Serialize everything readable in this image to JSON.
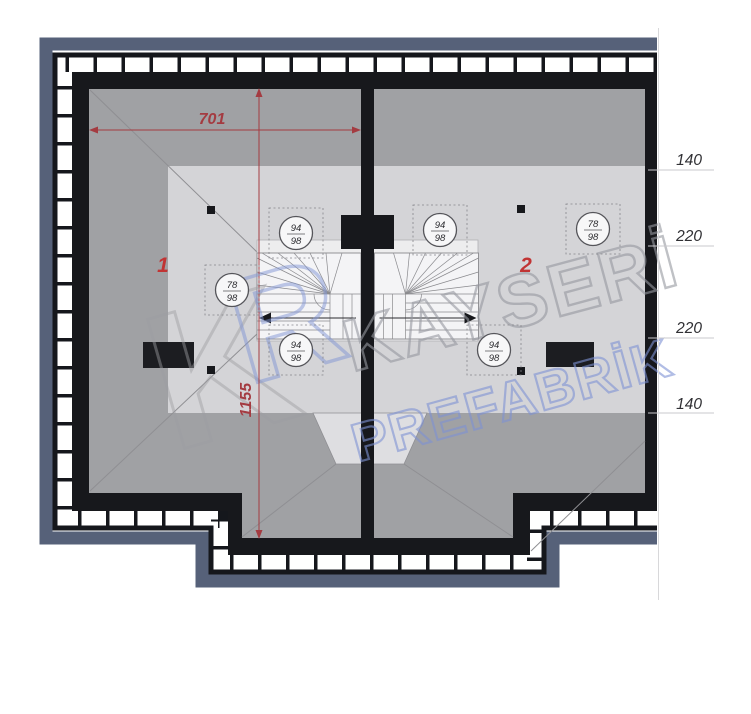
{
  "plan": {
    "title": "attic-roof-floor-plan",
    "dimension_width": "701",
    "dimension_height": "1155",
    "units": {
      "unit1": "1",
      "unit2": "2"
    },
    "right_dimensions": [
      "140",
      "220",
      "220",
      "140"
    ],
    "markers": [
      {
        "top": "94",
        "bottom": "98"
      },
      {
        "top": "94",
        "bottom": "98"
      },
      {
        "top": "78",
        "bottom": "98"
      },
      {
        "top": "78",
        "bottom": "98"
      },
      {
        "top": "94",
        "bottom": "98"
      },
      {
        "top": "94",
        "bottom": "98"
      }
    ],
    "watermark": {
      "brand_top": "KAYSERİ",
      "brand_bottom": "PREFABRİK",
      "emblem_letter_1": "K",
      "emblem_letter_2": "R"
    },
    "colors": {
      "wall_black": "#17181c",
      "roof_dark": "#a0a1a4",
      "roof_light": "#d4d4d7",
      "shadow_frame": "#566179",
      "dimension_red": "#a43b41",
      "unit_number_red": "#c13434",
      "watermark_blue": "#7e92d4",
      "watermark_gray": "#9698a0"
    }
  }
}
